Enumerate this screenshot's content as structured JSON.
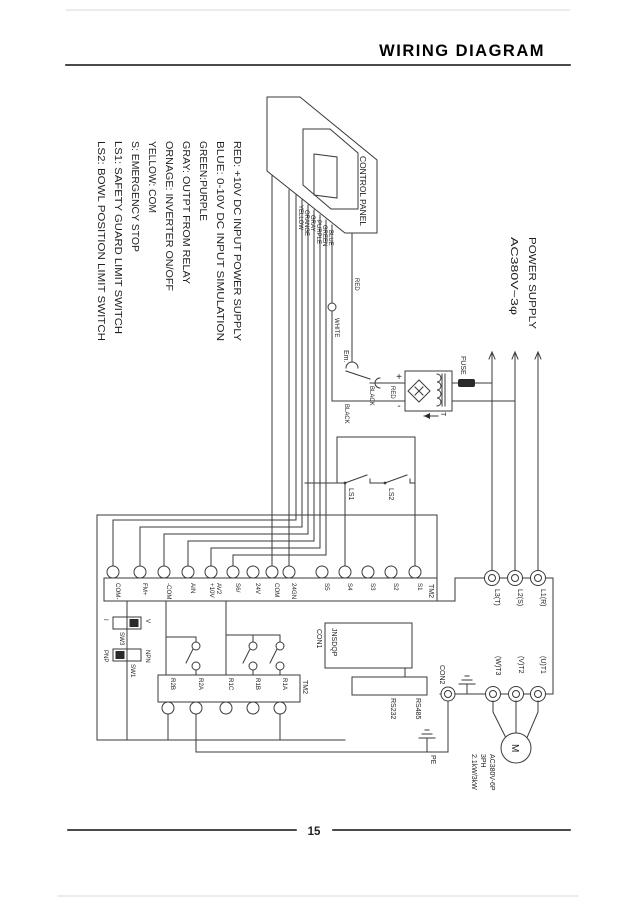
{
  "page": {
    "title": "WIRING DIAGRAM",
    "page_number": "15"
  },
  "legend": {
    "lines": [
      "RED: +10V DC INPUT POWER SUPPLY",
      "BLUE: 0-10V DC INPUT SIMULATION",
      "GREEN:PURPLE",
      "GRAY: OUTPT FROM RELAY",
      "ORNAGE: INVERTER ON/OFF",
      "YELLOW: COM",
      "S: EMERGENCY STOP",
      "LS1: SAFETY GUARD LIMIT SWITCH",
      "LS2: BOWL POSITION LIMIT SWITCH"
    ]
  },
  "control_panel": {
    "label": "CONTROL PANEL"
  },
  "wires": {
    "bundle": [
      "YELLOW",
      "ORANGE",
      "GRAY",
      "PURPLE",
      "GREEN",
      "BLUE"
    ],
    "white": "WHITE",
    "red": "RED",
    "black_a": "BLACK",
    "red_b": "RED",
    "black_b": "BLACK"
  },
  "em_switch": {
    "label": "Em."
  },
  "transformer": {
    "label": "T",
    "plus": "+",
    "minus": "-",
    "fuse": "FUSE"
  },
  "power_supply": {
    "lines": [
      "POWER SUPPLY",
      "AC380V~3φ"
    ]
  },
  "tm2_top": {
    "label": "TM2",
    "terminals": [
      "COM-",
      "FM+",
      "-COM",
      "AIN",
      "AV2",
      "S6/",
      "24V",
      "COM",
      "24GN",
      "S5",
      "S4",
      "S3",
      "S2",
      "S1"
    ],
    "av2_second_line": "+10V"
  },
  "limit_switches": {
    "ls1": "LS1",
    "ls2": "LS2"
  },
  "input_terminals": [
    "L3(T)",
    "L2(S)",
    "L1(R)"
  ],
  "output_terminals": [
    "(W)T3",
    "(V)T2",
    "(U)T1"
  ],
  "motor": {
    "symbol": "M",
    "spec": [
      "AC380V-6P",
      "3PH",
      "2.1kW/3kW"
    ]
  },
  "tm2_bottom": {
    "label": "TM2",
    "terminals": [
      "R2B",
      "R2A",
      "R1C",
      "R1B",
      "R1A"
    ]
  },
  "switches": {
    "sw3": {
      "label": "SW3",
      "left": "I",
      "right": "V"
    },
    "sw1": {
      "label": "SW1",
      "left": "PNP",
      "right": "NPN"
    }
  },
  "connectors": {
    "con1": "CON1",
    "con1_board": "JNSDQP",
    "con2": "CON2",
    "rs232": "RS232",
    "rs485": "RS485",
    "pe": "PE"
  }
}
